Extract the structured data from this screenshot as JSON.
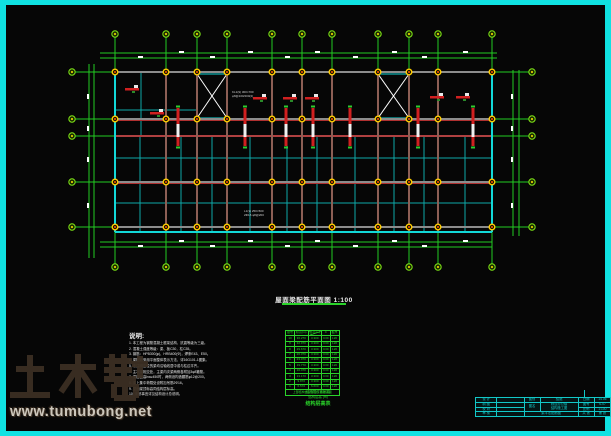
{
  "colors": {
    "frame_cyan": "#10e2e2",
    "axis_green": "#22cc22",
    "bubble_green": "#7fe817",
    "beam_gray": "#8c8c8c",
    "beam_red": "#d02020",
    "secondary_cyan": "#0ea8a8",
    "plan_border_cyan": "#12d8d8",
    "column_yellow": "#ffcc00",
    "table_green": "#2ad32a",
    "titleblock_cyan": "#14cdcd",
    "watermark_brown": "#3b2f23"
  },
  "plan": {
    "title": "屋面梁配筋平面图 1:100",
    "beam_label_1_line1": "KL1(9) 300×700",
    "beam_label_1_line2": "φ8@100/200(2)",
    "beam_label_2_line1": "L1(3) 250×500",
    "beam_label_2_line2": "2Φ16 φ8@200"
  },
  "notes": {
    "title": "说明:",
    "items": [
      "1. 本工程为钢筋混凝土框架结构，抗震等级为三级。",
      "2. 混凝土强度等级：梁、板C30，柱C35。",
      "3. 钢筋：HPB300(φ)、HRB400(Φ)，焊条E43、E50。",
      "4. 梁配筋采用平面整体表示方法，详16G101-1图集。",
      "5. 未注明定位的梁均沿轴线居中或与柱边平齐。",
      "6. 主次梁相交处，主梁内次梁两侧各附加3φ8箍筋。",
      "7. 梁腹板高hw≥450时，两侧设构造腰筋φ12@200。",
      "8. 梁上集中荷载处设附加吊筋2Φ16。",
      "9. 屋面梁顶标高同结构层标高。",
      "10. 未尽事宜详见结构设计总说明。"
    ]
  },
  "floor_table": {
    "header": [
      "层号",
      "标高(m)",
      "层高(m)",
      "C",
      "板厚"
    ],
    "rows": [
      [
        "10",
        "36.270",
        "3.300",
        "C30",
        "120"
      ],
      [
        "9",
        "32.970",
        "3.300",
        "C30",
        "120"
      ],
      [
        "8",
        "29.670",
        "3.300",
        "C30",
        "120"
      ],
      [
        "7",
        "26.370",
        "3.300",
        "C30",
        "120"
      ],
      [
        "6",
        "23.070",
        "3.300",
        "C30",
        "120"
      ],
      [
        "5",
        "19.770",
        "3.300",
        "C30",
        "120"
      ],
      [
        "4",
        "16.470",
        "3.300",
        "C30",
        "120"
      ],
      [
        "3",
        "13.170",
        "3.300",
        "C30",
        "120"
      ],
      [
        "2",
        "9.870",
        "3.300",
        "C30",
        "120"
      ],
      [
        "1",
        "6.570",
        "6.600",
        "C30",
        "120"
      ]
    ],
    "merged_footer": "上部结构嵌固部位：基础顶面",
    "foot_line_1": "结构层楼面标高",
    "foot_line_2": "结构层高 (m)",
    "table_title": "结构层高表"
  },
  "titleblock": {
    "design_label": "设 计",
    "draft_label": "制 图",
    "check_label": "校 对",
    "review_label": "审 核",
    "type_label": "图别",
    "type_value": "结施",
    "date_label": "日期",
    "date_value": "14.06",
    "name_label": "图名",
    "project_line1": "综合办公楼",
    "project_line2": "结构施工图",
    "sheet_title": "梁平法配筋图",
    "no_label": "图号",
    "no_value": "S-07",
    "scale_label": "比例",
    "scale_value": "1:100",
    "total_label": "共 张",
    "page_label": "第 张"
  },
  "watermark": {
    "brand": "土木帮",
    "url": "www.tumubong.net"
  }
}
